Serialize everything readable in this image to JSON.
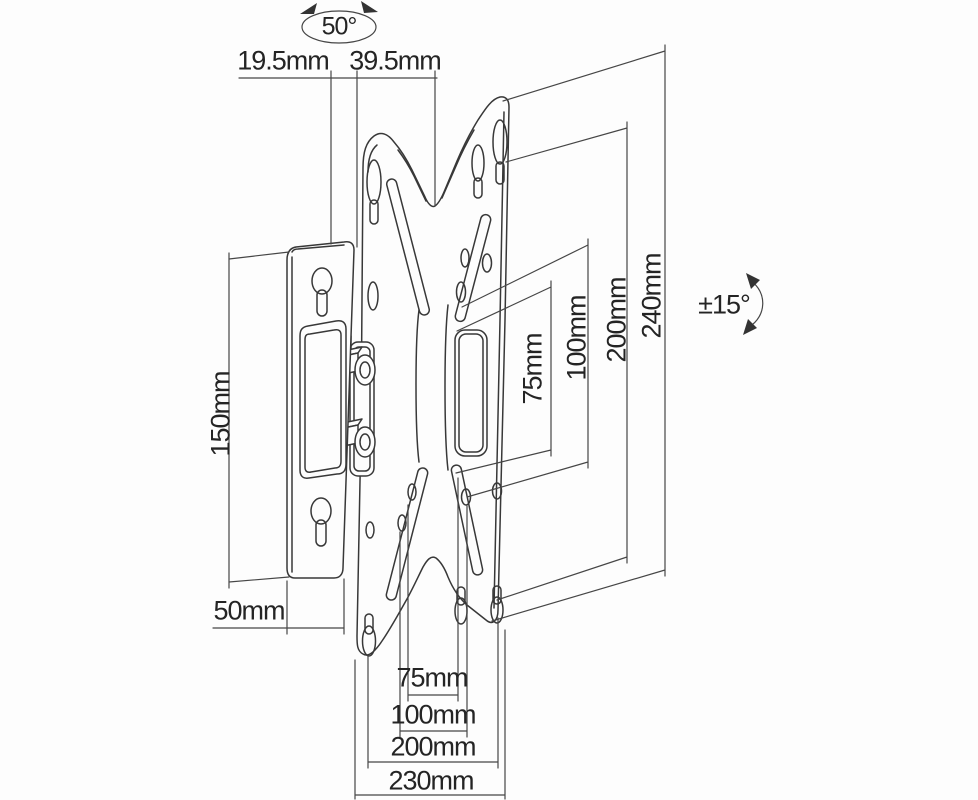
{
  "labels": {
    "swivel_angle": "50°",
    "tilt_angle": "±15°",
    "wall_offset_depth": "19.5mm",
    "bracket_depth": "39.5mm",
    "wall_plate_height": "150mm",
    "wall_plate_width": "50mm",
    "vesa_height_75": "75mm",
    "vesa_height_100": "100mm",
    "plate_height_200": "200mm",
    "plate_height_240": "240mm",
    "vesa_width_75": "75mm",
    "vesa_width_100": "100mm",
    "plate_width_200": "200mm",
    "plate_width_230": "230mm"
  },
  "colors": {
    "line": "#383838",
    "dimension_line": "#464646",
    "text": "#242424",
    "background": "#fdfdfd"
  }
}
